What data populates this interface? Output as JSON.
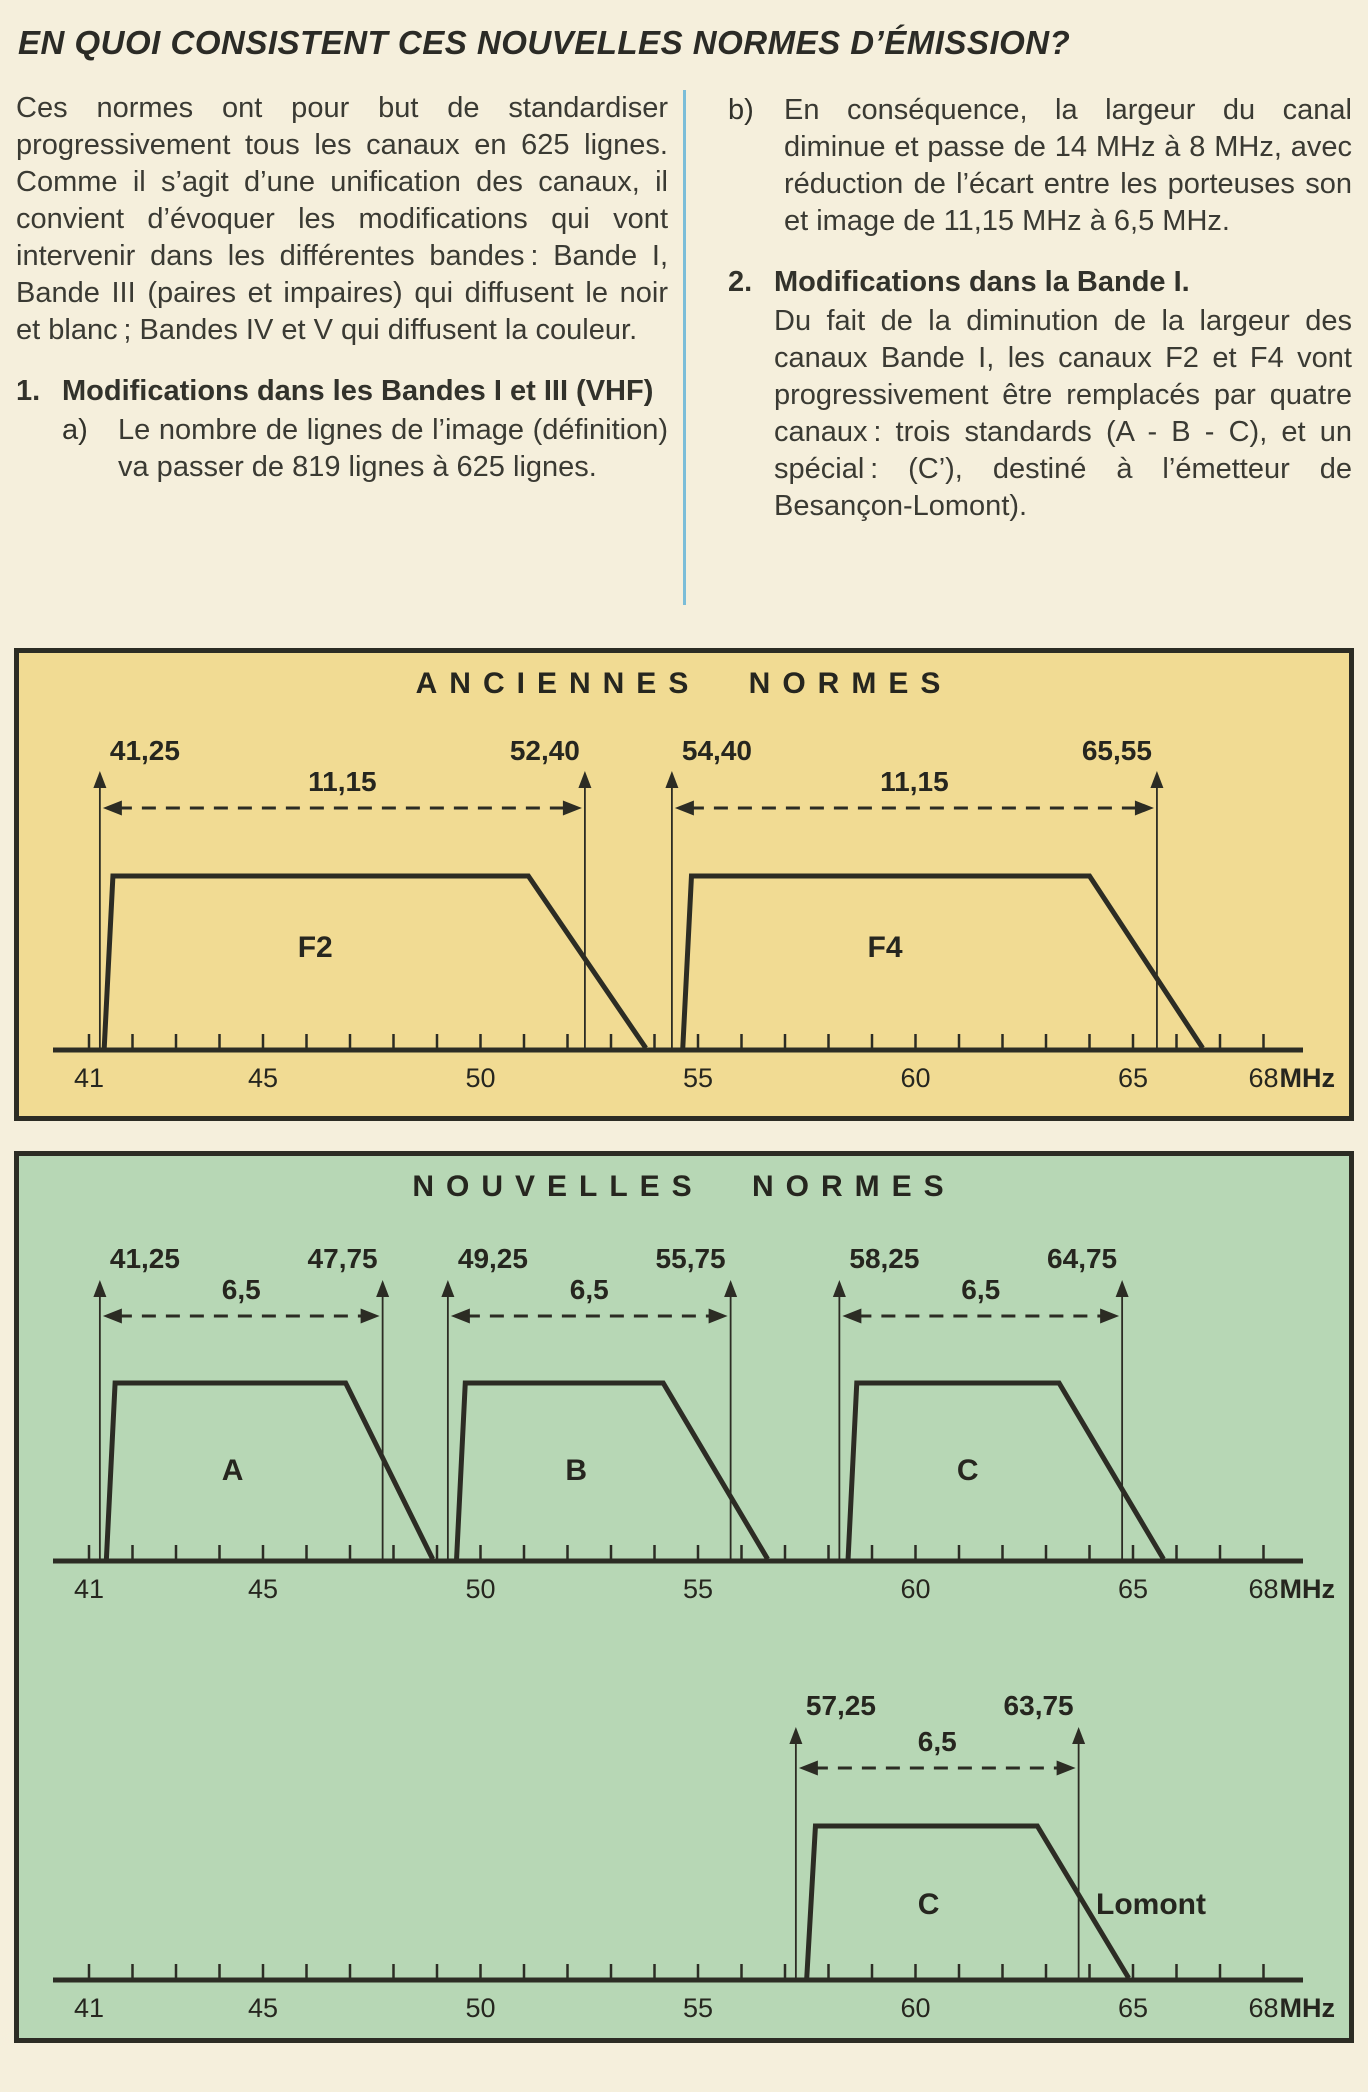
{
  "page": {
    "title": "EN QUOI CONSISTENT CES NOUVELLES NORMES D’ÉMISSION?"
  },
  "colors": {
    "page_bg": "#f5efdc",
    "panel_yellow": "#f1db93",
    "panel_green": "#b7d7b5",
    "line_dark": "#2c2c24",
    "divider_blue": "#7bbdd8",
    "text": "#3a3a33"
  },
  "columns": {
    "left": {
      "intro": "Ces normes ont pour but de standardiser progressivement tous les canaux en 625 lignes. Comme il s’agit d’une unification des canaux, il convient d’évoquer les modifications qui vont intervenir dans les différentes bandes : Bande I, Bande III (paires et impaires) qui diffusent le noir et blanc ; Bandes IV et V qui diffusent la couleur.",
      "item1_num": "1.",
      "item1_title": "Modifications dans les Bandes I et III (VHF)",
      "item1a_num": "a)",
      "item1a_text": "Le nombre de lignes de l’image (définition) va passer de 819 lignes à 625 lignes."
    },
    "right": {
      "itemb_num": "b)",
      "itemb_text": "En conséquence, la largeur du canal diminue et passe de 14 MHz à 8 MHz, avec réduction de l’écart entre les porteuses son et image de 11,15 MHz à 6,5 MHz.",
      "item2_num": "2.",
      "item2_title": "Modifications dans la Bande I.",
      "item2_text": "Du fait de la diminution de la largeur des canaux Bande I, les canaux F2 et F4 vont progressivement être remplacés par quatre canaux : trois standards (A - B - C), et un spécial : (C’), destiné à l’émetteur de Besançon-Lomont)."
    }
  },
  "chart_data": [
    {
      "type": "area",
      "title": "ANCIENNES NORMES",
      "panel_bg": "#f1db93",
      "axis": {
        "min": 41,
        "max": 68,
        "unit": "MHz",
        "minor_step": 1,
        "ticks": [
          {
            "v": 41,
            "label": "41"
          },
          {
            "v": 45,
            "label": "45"
          },
          {
            "v": 50,
            "label": "50"
          },
          {
            "v": 55,
            "label": "55"
          },
          {
            "v": 60,
            "label": "60"
          },
          {
            "v": 65,
            "label": "65"
          },
          {
            "v": 68,
            "label": "68"
          }
        ]
      },
      "channels": [
        {
          "name": "F2",
          "rise": 41.35,
          "top_start": 41.55,
          "top_end": 51.1,
          "foot": 53.8,
          "label_x": 46.2
        },
        {
          "name": "F4",
          "rise": 54.65,
          "top_start": 54.85,
          "top_end": 64.0,
          "foot": 66.6,
          "label_x": 59.3
        }
      ],
      "measures": [
        {
          "from": 41.25,
          "to": 52.4,
          "from_label": "41,25",
          "to_label": "52,40",
          "width_label": "11,15"
        },
        {
          "from": 54.4,
          "to": 65.55,
          "from_label": "54,40",
          "to_label": "65,55",
          "width_label": "11,15"
        }
      ]
    },
    {
      "type": "area",
      "title": "NOUVELLES NORMES",
      "panel_bg": "#b7d7b5",
      "axis": {
        "min": 41,
        "max": 68,
        "unit": "MHz",
        "minor_step": 1,
        "ticks": [
          {
            "v": 41,
            "label": "41"
          },
          {
            "v": 45,
            "label": "45"
          },
          {
            "v": 50,
            "label": "50"
          },
          {
            "v": 55,
            "label": "55"
          },
          {
            "v": 60,
            "label": "60"
          },
          {
            "v": 65,
            "label": "65"
          },
          {
            "v": 68,
            "label": "68"
          }
        ]
      },
      "channels": [
        {
          "name": "A",
          "rise": 41.4,
          "top_start": 41.6,
          "top_end": 46.9,
          "foot": 48.9,
          "label_x": 44.3
        },
        {
          "name": "B",
          "rise": 49.45,
          "top_start": 49.65,
          "top_end": 54.2,
          "foot": 56.6,
          "label_x": 52.2
        },
        {
          "name": "C",
          "rise": 58.45,
          "top_start": 58.65,
          "top_end": 63.3,
          "foot": 65.7,
          "label_x": 61.2
        }
      ],
      "measures": [
        {
          "from": 41.25,
          "to": 47.75,
          "from_label": "41,25",
          "to_label": "47,75",
          "width_label": "6,5"
        },
        {
          "from": 49.25,
          "to": 55.75,
          "from_label": "49,25",
          "to_label": "55,75",
          "width_label": "6,5"
        },
        {
          "from": 58.25,
          "to": 64.75,
          "from_label": "58,25",
          "to_label": "64,75",
          "width_label": "6,5"
        }
      ]
    },
    {
      "type": "area",
      "title": "",
      "panel_bg": "#b7d7b5",
      "axis": {
        "min": 41,
        "max": 68,
        "unit": "MHz",
        "minor_step": 1,
        "ticks": [
          {
            "v": 41,
            "label": "41"
          },
          {
            "v": 45,
            "label": "45"
          },
          {
            "v": 50,
            "label": "50"
          },
          {
            "v": 55,
            "label": "55"
          },
          {
            "v": 60,
            "label": "60"
          },
          {
            "v": 65,
            "label": "65"
          },
          {
            "v": 68,
            "label": "68"
          }
        ]
      },
      "channels": [
        {
          "name": "C",
          "rise": 57.5,
          "top_start": 57.7,
          "top_end": 62.8,
          "foot": 64.9,
          "label_x": 60.3,
          "side_label": "Lomont",
          "side_label_x": 64.15
        }
      ],
      "measures": [
        {
          "from": 57.25,
          "to": 63.75,
          "from_label": "57,25",
          "to_label": "63,75",
          "width_label": "6,5"
        }
      ]
    }
  ]
}
